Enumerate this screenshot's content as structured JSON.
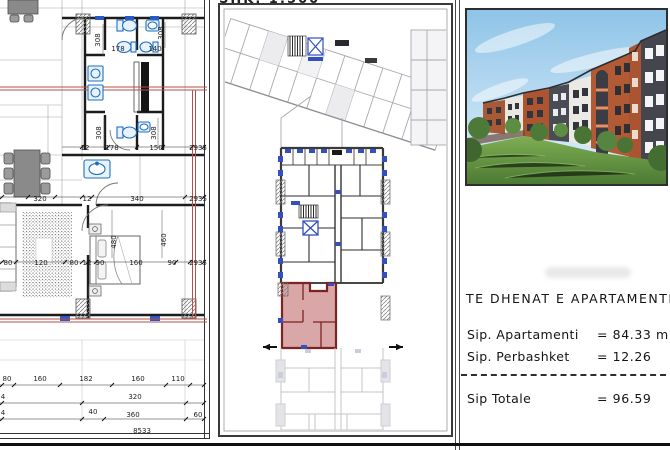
{
  "sheet": {
    "scale_label": "SHK. 1:500",
    "info": {
      "title": "TE DHENAT E APARTAMENTIT",
      "rows": [
        {
          "label": "Sip. Apartamenti",
          "value": "= 84.33 m"
        },
        {
          "label": "Sip. Perbashket",
          "value": "= 12.26"
        }
      ],
      "total": {
        "label": "Sip Totale",
        "value": "= 96.59"
      }
    }
  },
  "floor_plan": {
    "dim_labels": [
      {
        "t": "308",
        "x": 100,
        "y": 40,
        "r": -90
      },
      {
        "t": "308",
        "x": 163,
        "y": 33,
        "r": -90
      },
      {
        "t": "178",
        "x": 118,
        "y": 51
      },
      {
        "t": "140",
        "x": 155,
        "y": 51
      },
      {
        "t": "308",
        "x": 101,
        "y": 133,
        "r": -90
      },
      {
        "t": "308",
        "x": 156,
        "y": 133,
        "r": -90
      },
      {
        "t": "12",
        "x": 85,
        "y": 150
      },
      {
        "t": "178",
        "x": 112,
        "y": 150
      },
      {
        "t": "150",
        "x": 156,
        "y": 150
      },
      {
        "t": "2935",
        "x": 198,
        "y": 150
      },
      {
        "t": "320",
        "x": 40,
        "y": 201
      },
      {
        "t": "12",
        "x": 87,
        "y": 201
      },
      {
        "t": "340",
        "x": 137,
        "y": 201
      },
      {
        "t": "2935",
        "x": 198,
        "y": 201
      },
      {
        "t": "80",
        "x": 8,
        "y": 265
      },
      {
        "t": "120",
        "x": 41,
        "y": 265
      },
      {
        "t": "80",
        "x": 74,
        "y": 265
      },
      {
        "t": "12",
        "x": 87,
        "y": 265
      },
      {
        "t": "90",
        "x": 100,
        "y": 265
      },
      {
        "t": "160",
        "x": 136,
        "y": 265
      },
      {
        "t": "90",
        "x": 172,
        "y": 265
      },
      {
        "t": "2935",
        "x": 198,
        "y": 265
      },
      {
        "t": "480",
        "x": 116,
        "y": 242,
        "r": -90
      },
      {
        "t": "460",
        "x": 166,
        "y": 240,
        "r": -90
      },
      {
        "t": "80",
        "x": 7,
        "y": 381
      },
      {
        "t": "160",
        "x": 40,
        "y": 381
      },
      {
        "t": "182",
        "x": 86,
        "y": 381
      },
      {
        "t": "160",
        "x": 138,
        "y": 381
      },
      {
        "t": "110",
        "x": 178,
        "y": 381
      },
      {
        "t": "4",
        "x": 3,
        "y": 399
      },
      {
        "t": "320",
        "x": 135,
        "y": 399
      },
      {
        "t": "4",
        "x": 3,
        "y": 415
      },
      {
        "t": "40",
        "x": 93,
        "y": 414
      },
      {
        "t": "360",
        "x": 133,
        "y": 417
      },
      {
        "t": "60",
        "x": 198,
        "y": 417
      },
      {
        "t": "8533",
        "x": 142,
        "y": 433
      }
    ]
  },
  "colors": {
    "highlight_fill": "#d6a0a0",
    "highlight_wall": "#7d2321",
    "fixture_blue": "#1f6fbf",
    "window_blue": "#3350bd",
    "section_red": "#b3524a"
  }
}
